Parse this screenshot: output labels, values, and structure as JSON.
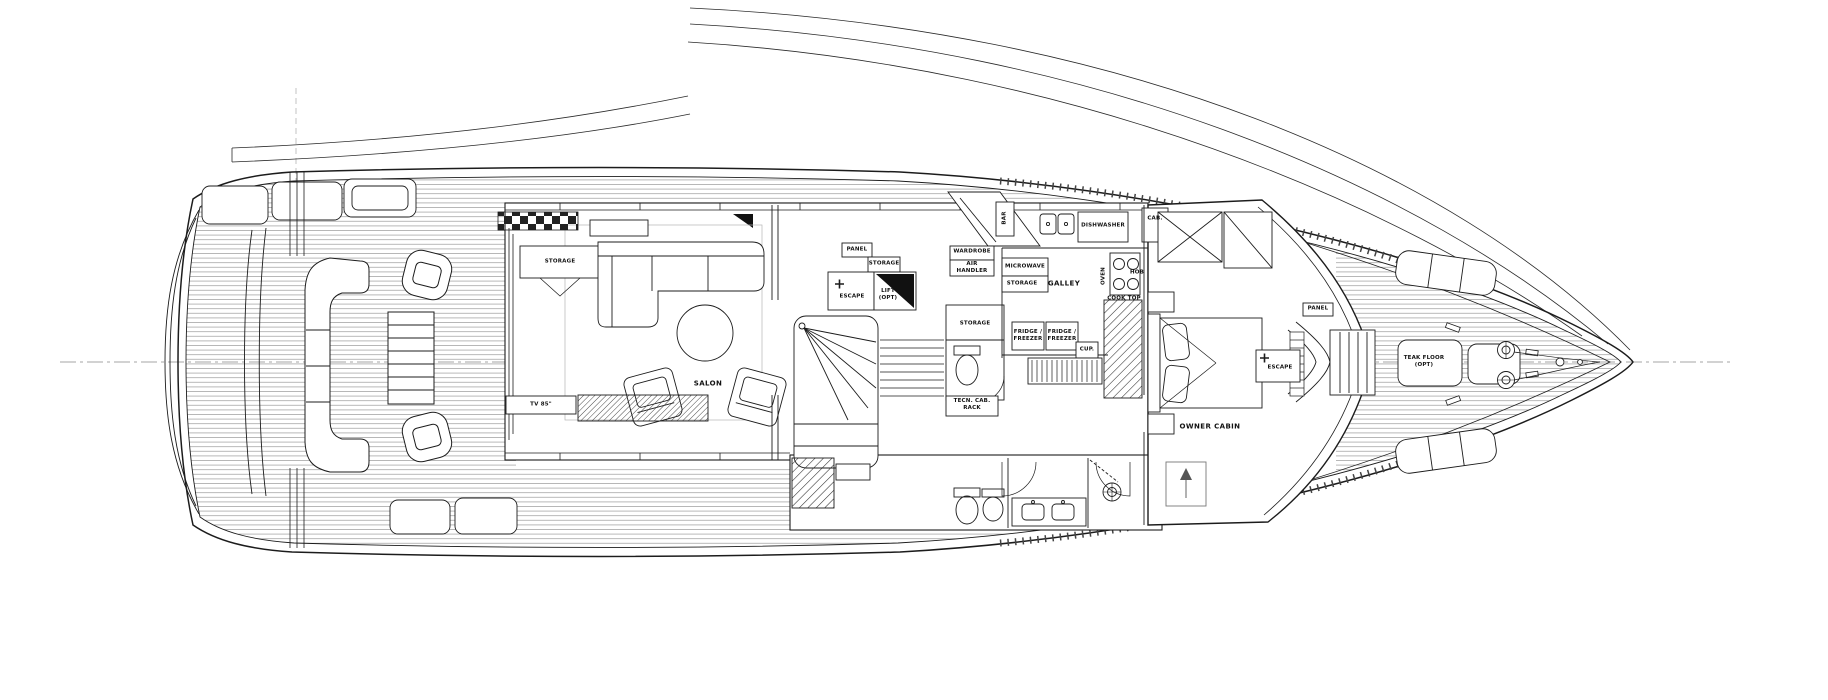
{
  "colors": {
    "background": "#ffffff",
    "line": "#1c1c1c",
    "plank": "#999999"
  },
  "labels": {
    "storage_aft": {
      "text": "STORAGE"
    },
    "tv": {
      "text": "TV 85\""
    },
    "salon": {
      "text": "SALON"
    },
    "panel_mid": {
      "text": "PANEL"
    },
    "storage_lift": {
      "text": "STORAGE"
    },
    "escape_mid": {
      "text": "ESCAPE"
    },
    "lift": {
      "text": "LIFT\n(OPT)"
    },
    "wardrobe": {
      "text": "WARDROBE"
    },
    "air_handler": {
      "text": "AIR\nHANDLER"
    },
    "microwave": {
      "text": "MICROWAVE"
    },
    "storage_galley": {
      "text": "STORAGE"
    },
    "galley": {
      "text": "GALLEY"
    },
    "oven": {
      "text": "OVEN"
    },
    "hob": {
      "text": "HOB"
    },
    "cooktop": {
      "text": "COOK TOP"
    },
    "fridge1": {
      "text": "FRIDGE /\nFREEZER"
    },
    "fridge2": {
      "text": "FRIDGE /\nFREEZER"
    },
    "cup": {
      "text": "CUP."
    },
    "dishwasher": {
      "text": "DISHWASHER"
    },
    "bar": {
      "text": "BAR"
    },
    "cab": {
      "text": "CAB."
    },
    "storage_dayhead": {
      "text": "STORAGE"
    },
    "tecn_rack": {
      "text": "TECN. CAB.\nRACK"
    },
    "owner_cabin": {
      "text": "OWNER CABIN"
    },
    "escape_fwd": {
      "text": "ESCAPE"
    },
    "panel_fwd": {
      "text": "PANEL"
    },
    "teak_floor": {
      "text": "TEAK FLOOR\n(OPT)"
    }
  }
}
